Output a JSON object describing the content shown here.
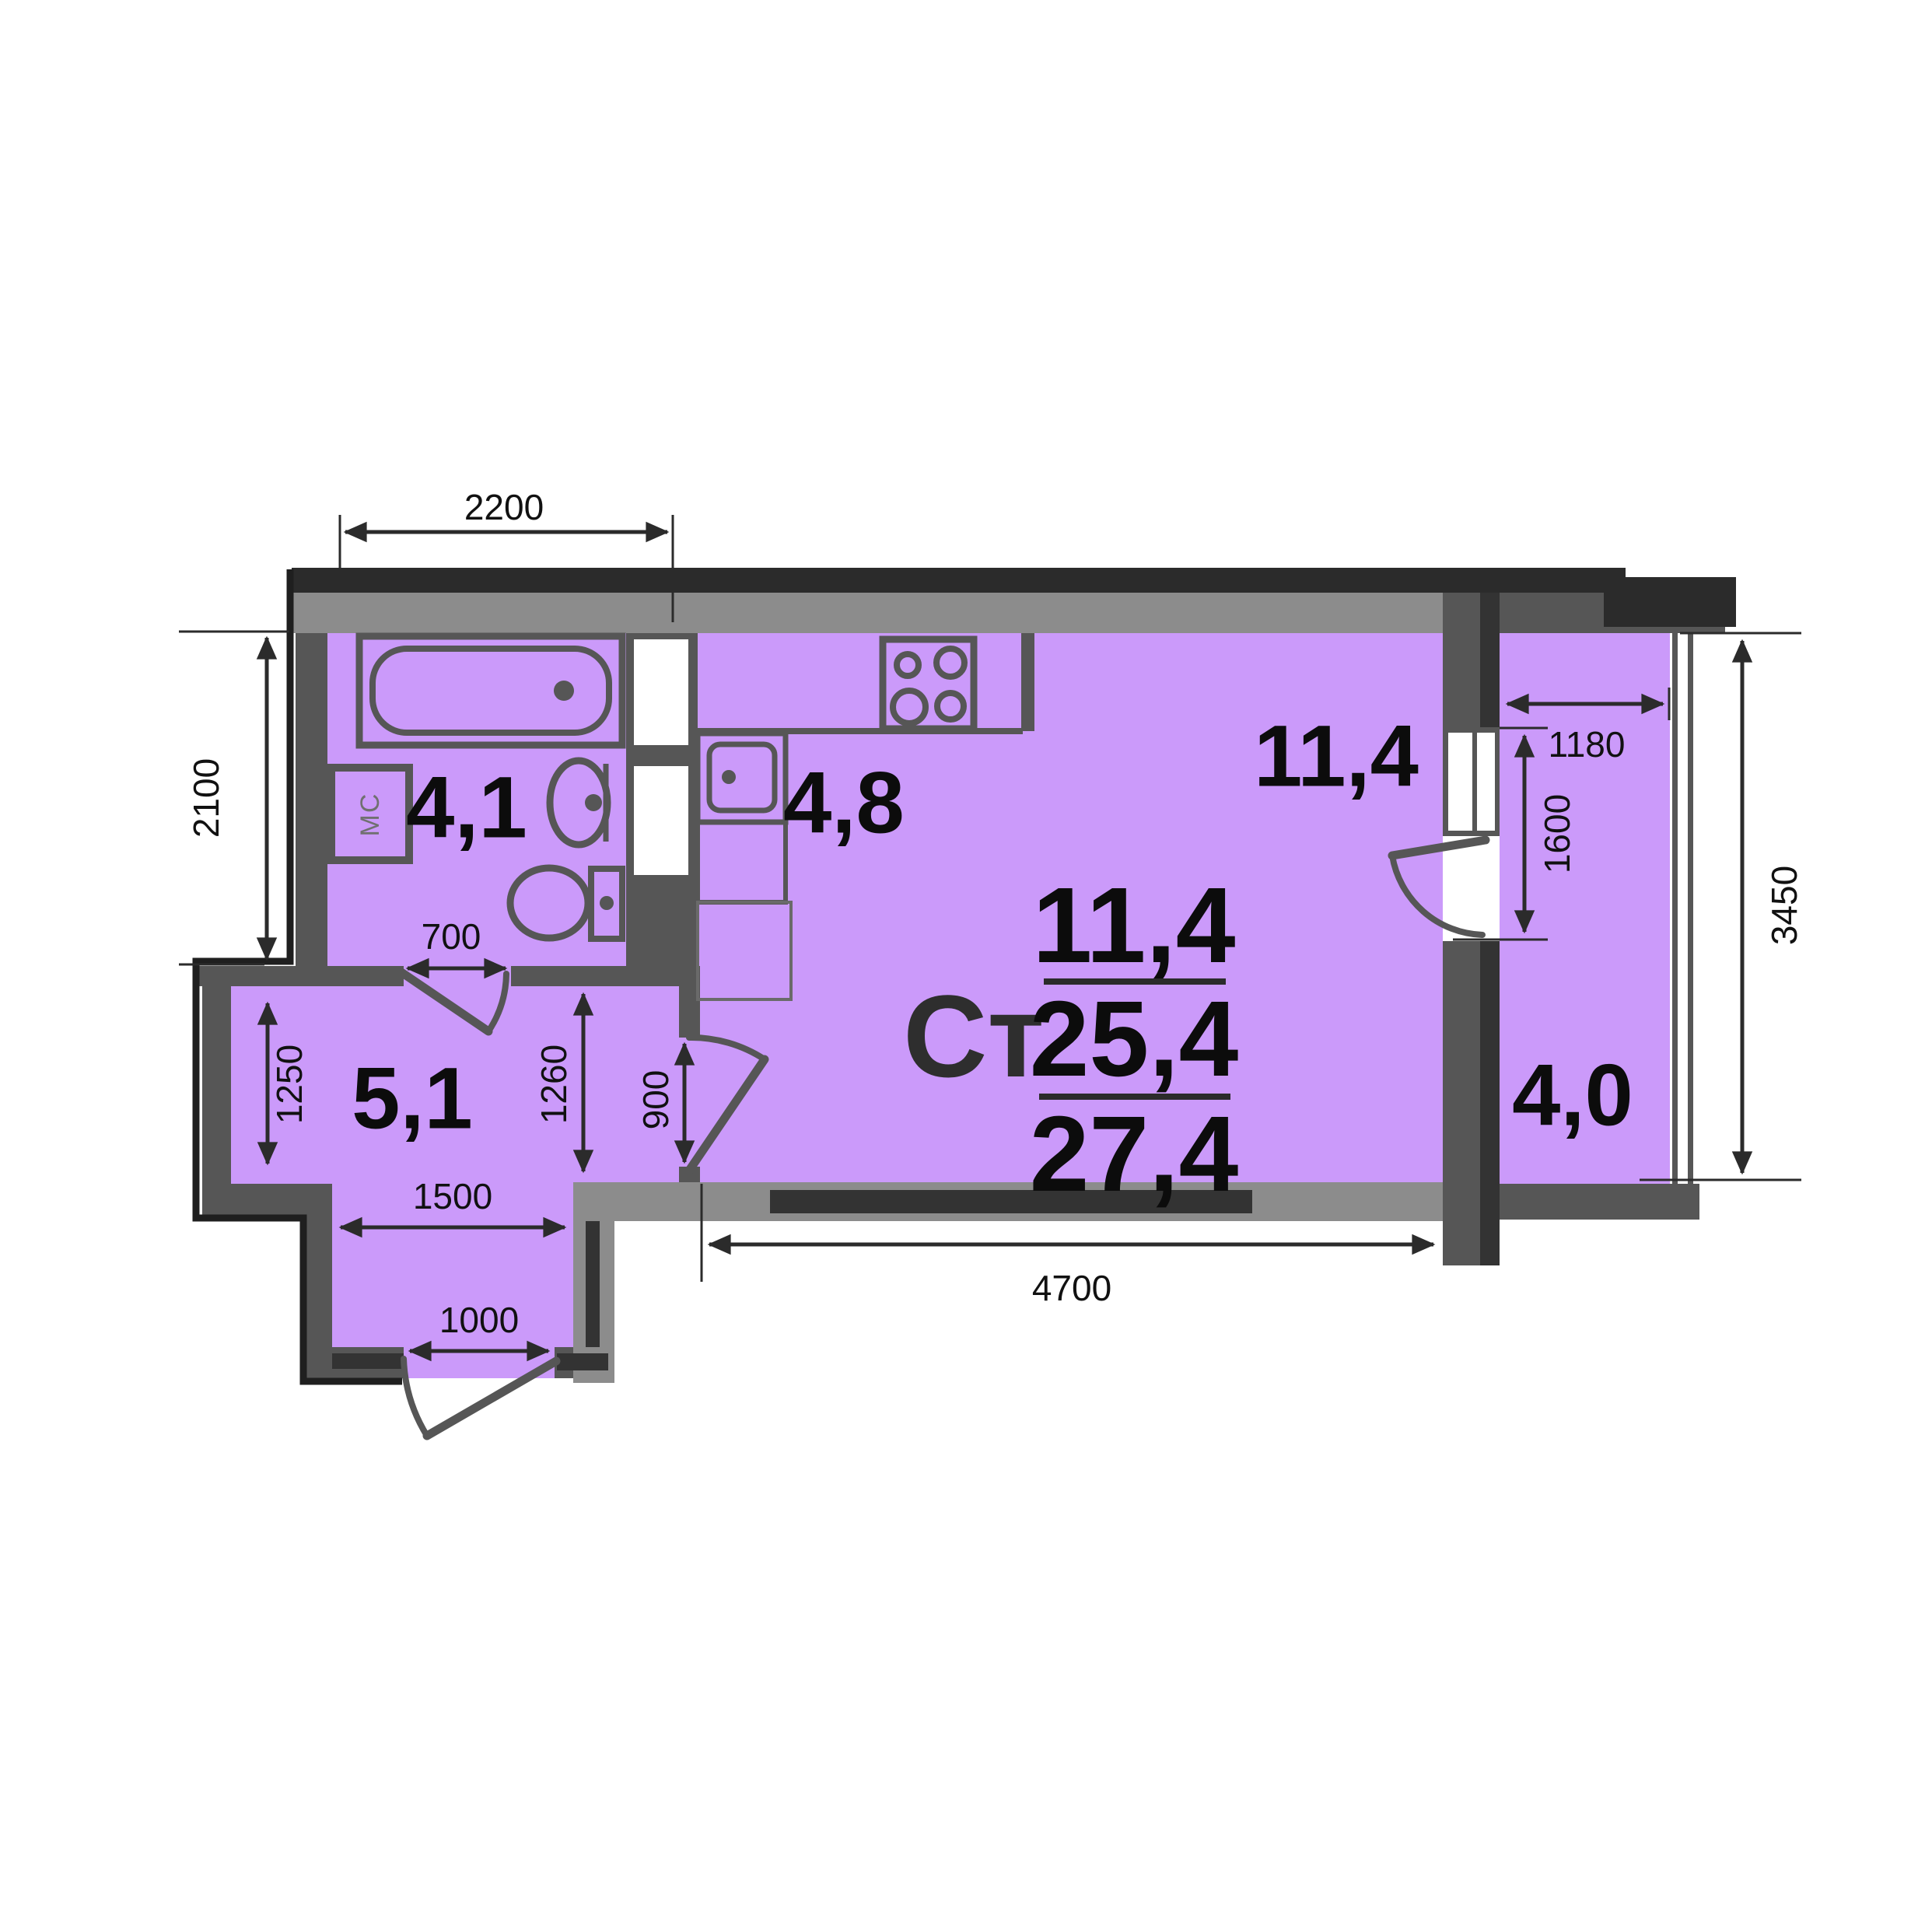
{
  "plan": {
    "summary": {
      "type_label": "Ст",
      "living_area": "11,4",
      "apartment_area": "25,4",
      "total_area": "27,4"
    },
    "rooms": {
      "bathroom": "4,1",
      "kitchen": "4,8",
      "hall": "5,1",
      "living_room": "11,4",
      "balcony": "4,0"
    },
    "fixtures": {
      "washing_machine": "МС"
    },
    "dimensions": {
      "d2200": "2200",
      "d2100": "2100",
      "d700": "700",
      "d1250": "1250",
      "d1500": "1500",
      "d1000": "1000",
      "d1260": "1260",
      "d900": "900",
      "d4700": "4700",
      "d1180": "1180",
      "d1600": "1600",
      "d3450": "3450"
    },
    "colors": {
      "floor": "#cb9afa",
      "wall": "#565656",
      "wall_black": "#2b2b2b",
      "wall_light": "#8c8c8c",
      "wall_stripe": "#333333"
    }
  }
}
